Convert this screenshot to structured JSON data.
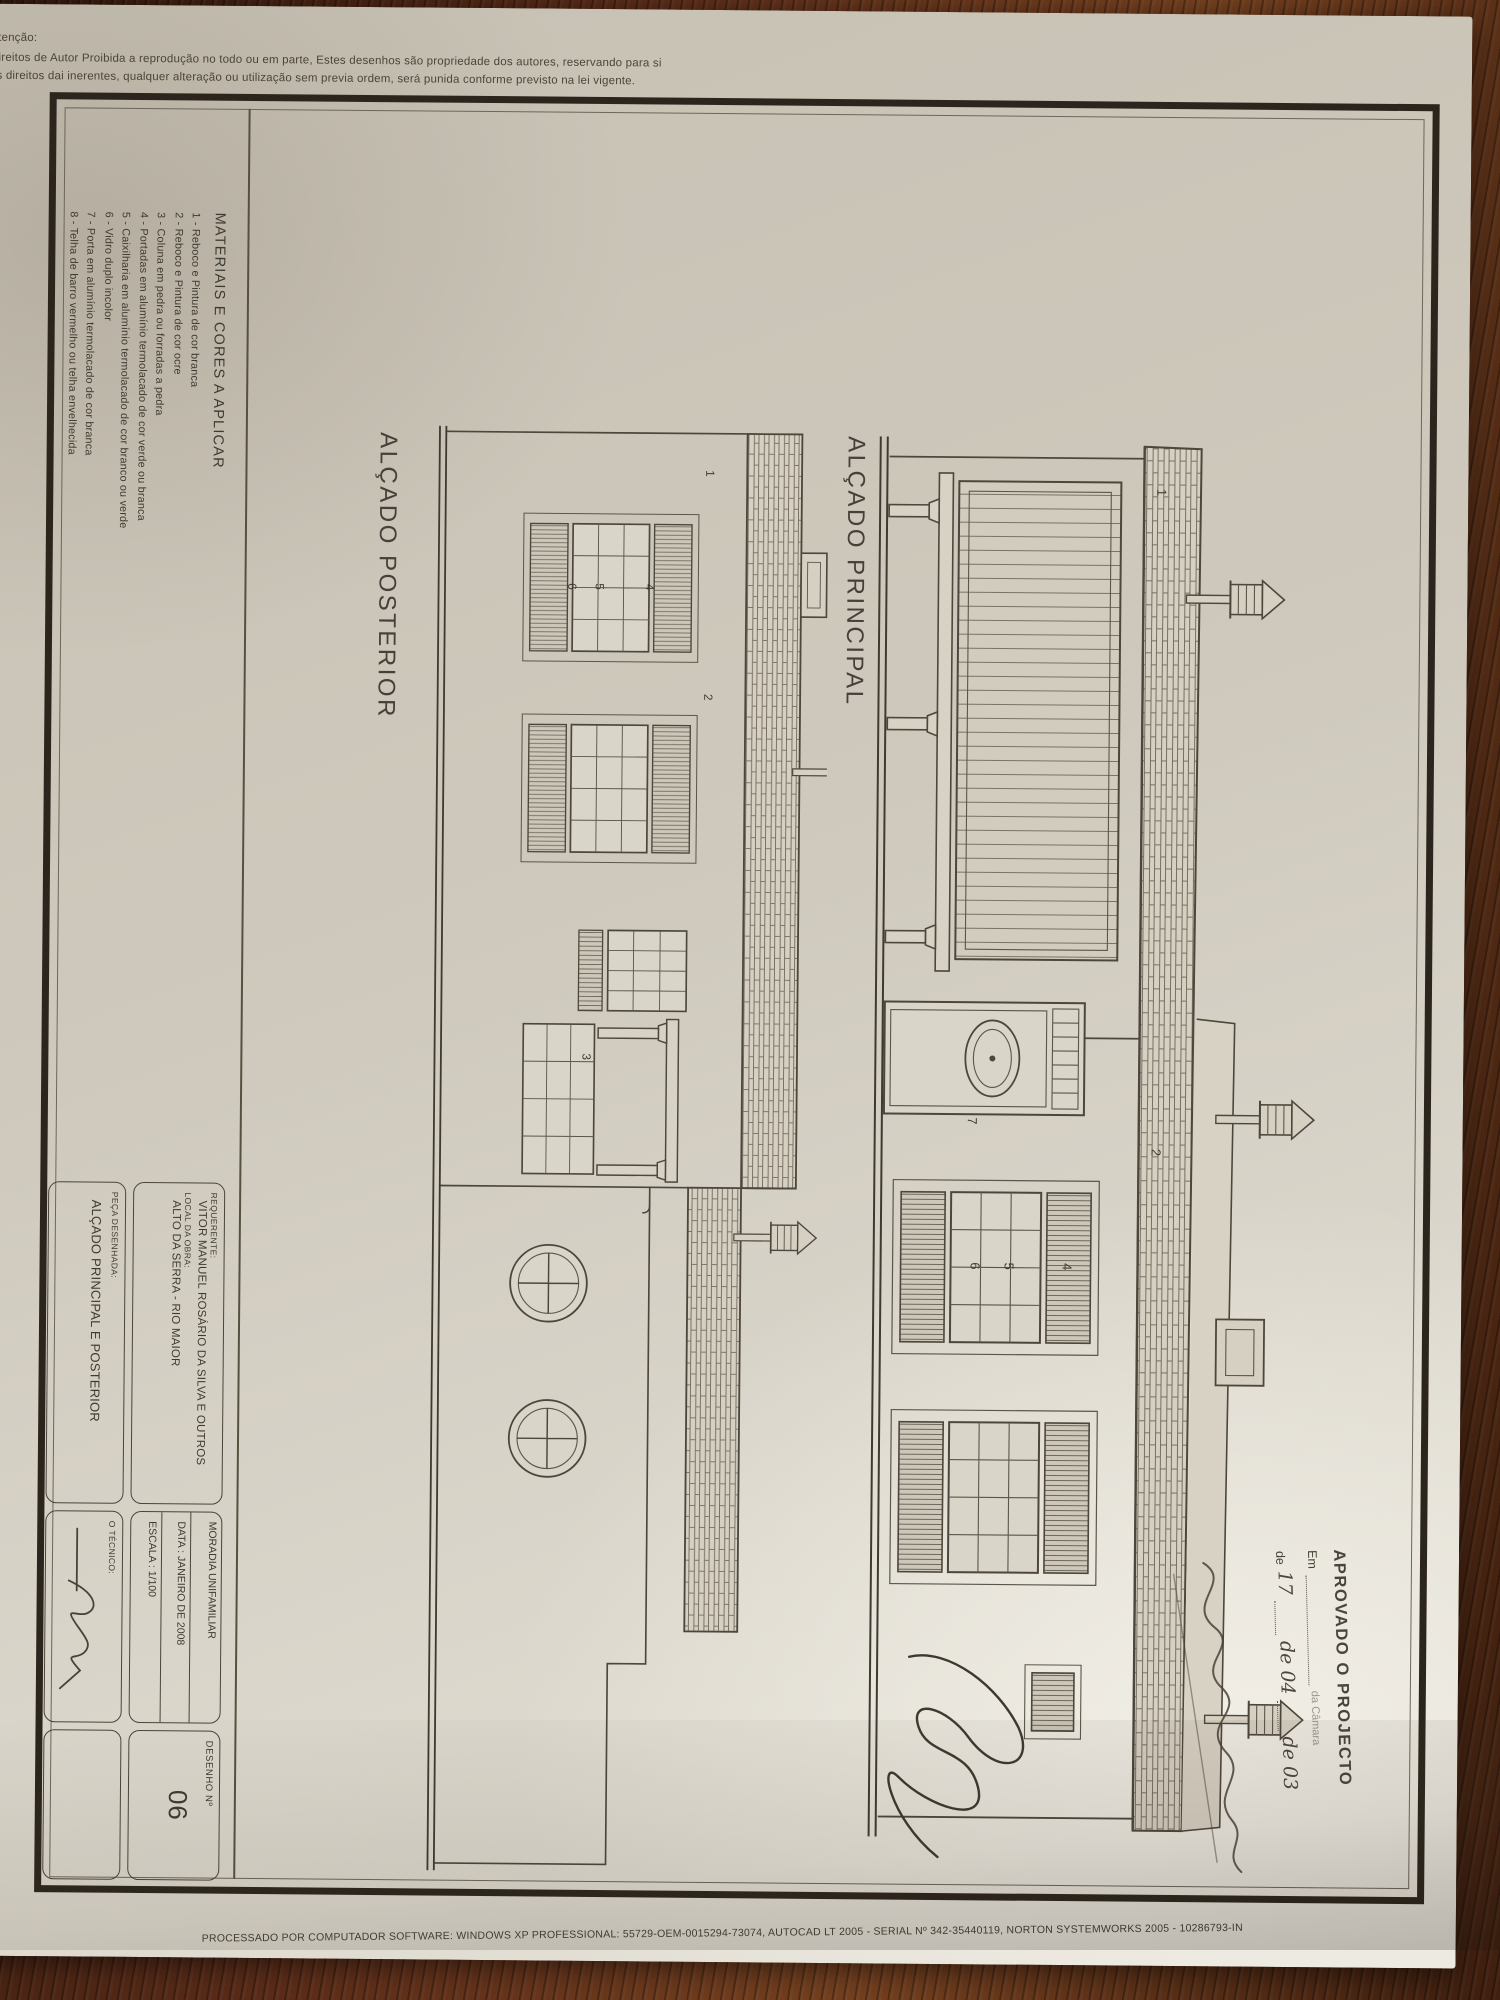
{
  "header": {
    "attention": "Atenção:",
    "line1": "Direitos de Autor Proibida a reprodução no todo ou em parte, Estes desenhos são propriedade dos autores, reservando para si",
    "line2": "os direitos dai inerentes, qualquer alteração ou utilização sem previa ordem, será punida conforme previsto na lei vigente."
  },
  "footer": {
    "processing_line": "PROCESSADO POR COMPUTADOR SOFTWARE: WINDOWS XP PROFESSIONAL: 55729-OEM-0015294-73074, AUTOCAD LT 2005 - SERIAL Nº 342-35440119, NORTON SYSTEMWORKS 2005 - 10286793-IN"
  },
  "materials": {
    "title": "MATERIAIS E CORES A APLICAR",
    "items": [
      "1 - Reboco e Pintura de cor branca",
      "2 - Reboco e Pintura de cor ocre",
      "3 - Coluna em pedra ou forradas a pedra",
      "4 - Portadas em alumínio termolacado de cor verde ou branca",
      "5 - Caixilharia em alumínio termolacado de cor branco ou verde",
      "6 - Vidro duplo incolor",
      "7 - Porta em alumínio termolacado de cor branca",
      "8 - Telha de barro vermelho ou telha envelhecida"
    ]
  },
  "elevations": {
    "principal": {
      "title": "ALÇADO PRINCIPAL",
      "callouts": [
        "1",
        "2",
        "4",
        "5",
        "6",
        "7"
      ]
    },
    "posterior": {
      "title": "ALÇADO POSTERIOR",
      "callouts": [
        "1",
        "2",
        "3",
        "4",
        "5",
        "6"
      ]
    }
  },
  "title_block": {
    "requerente_label": "REQUERENTE:",
    "requerente": "VITOR MANUEL ROSÁRIO DA SILVA E OUTROS",
    "local_label": "LOCAL DA OBRA:",
    "local": "ALTO DA SERRA - RIO MAIOR",
    "tipo": "MORADIA UNIFAMILIAR",
    "data_line": "DATA : JANEIRO DE 2008",
    "escala_line": "ESCALA : 1/100",
    "peca_label": "PEÇA DESENHADA:",
    "peca": "ALÇADO PRINCIPAL E POSTERIOR",
    "tecnico_label": "O TÉCNICO:",
    "desenho_label": "DESENHO  Nº",
    "desenho_num": "06"
  },
  "stamp": {
    "title": "APROVADO O PROJECTO",
    "em_label": "Em",
    "camara_note": "da Câmara",
    "date_parts": [
      "de",
      "17",
      "de 04",
      "de 03"
    ]
  },
  "colors": {
    "paper": "#cfc9bd",
    "ink": "#3f3a31",
    "stamp_ink": "#4a443c",
    "wood": "#5c2d19"
  }
}
